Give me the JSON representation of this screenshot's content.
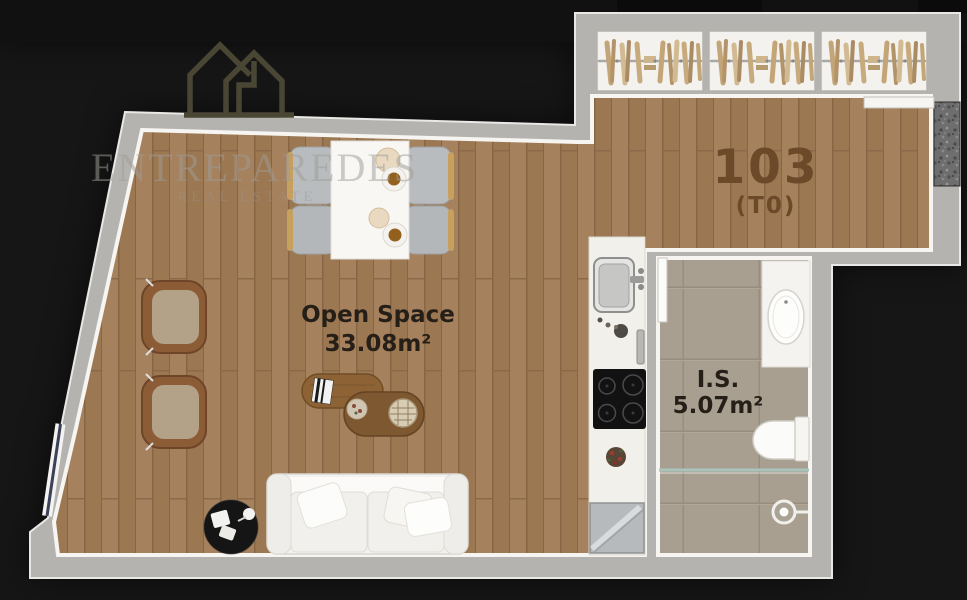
{
  "plan": {
    "unit_number": "103",
    "unit_type": "(T0)",
    "open_space": {
      "label": "Open Space",
      "area": "33.08m²"
    },
    "bathroom": {
      "label": "I.S.",
      "area": "5.07m²"
    },
    "rooms": [
      {
        "name": "Open Space",
        "area": "33.08m²"
      },
      {
        "name": "I.S.",
        "area": "5.07m²"
      }
    ],
    "furniture_icons": [
      "wardrobe-hangers-icon",
      "dining-table",
      "dining-chairs",
      "plates-icon",
      "armchair",
      "coffee-table",
      "book-icon",
      "sofa",
      "pillows",
      "side-table",
      "kitchen-sink-icon",
      "faucet-icon",
      "cooktop-icon",
      "refrigerator",
      "plant-icon",
      "vanity-basin-icon",
      "toilet-icon",
      "shower-head-icon",
      "shower-glass",
      "window",
      "door-leaf",
      "entry-granite-mat"
    ]
  },
  "watermark": {
    "brand": "ENTREPAREDES",
    "tagline": "REAL ESTATE",
    "logo": "twin-house-outline-icon"
  },
  "colors": {
    "background": "#161616",
    "wall_gray": "#b5b3b0",
    "wall_lining": "#f6f5f2",
    "wood_floor": "#a17c57",
    "bath_tile": "#a89f91",
    "counter_white": "#f2f0ea",
    "unit_label_brown": "#6b4929",
    "room_label_dark": "#261f18",
    "watermark_gray": "#9e9b96",
    "logo_olive": "#4a4634",
    "window_glass": "#3a4158",
    "shower_glass": "#a9c4bb"
  }
}
